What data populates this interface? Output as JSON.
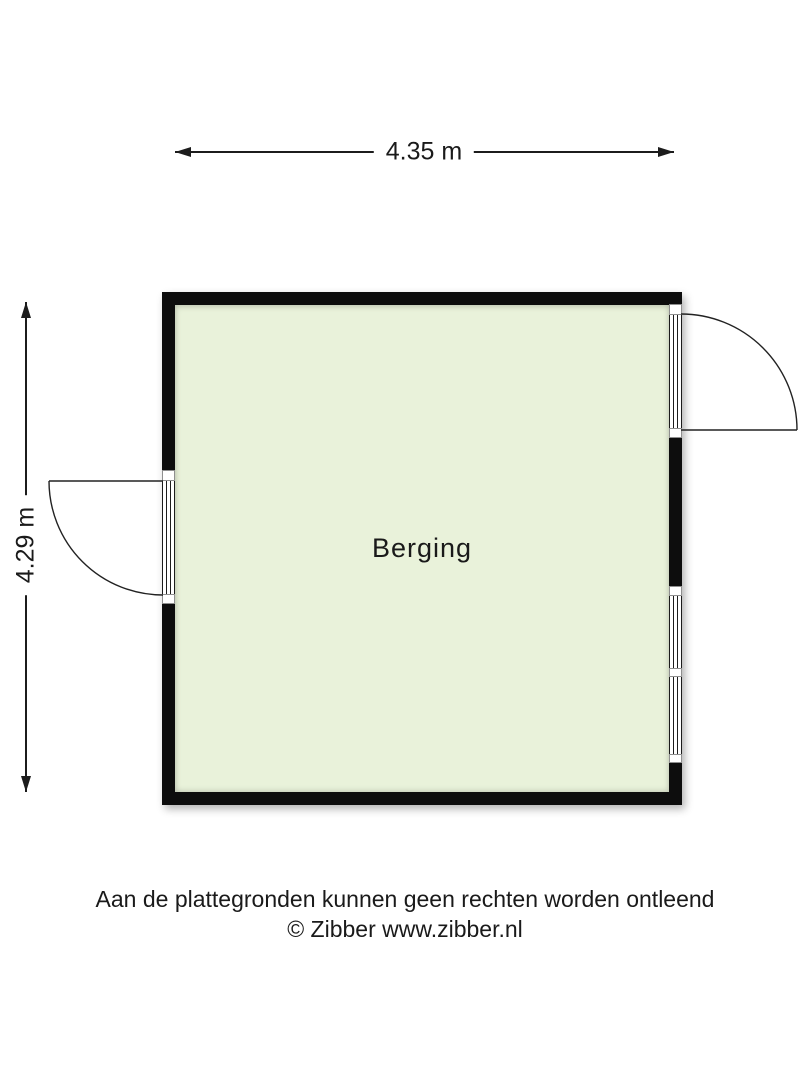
{
  "dimensions": {
    "width_label": "4.35 m",
    "height_label": "4.29 m"
  },
  "plan": {
    "room_label": "Berging",
    "features": {
      "left_door": "door-swing-left",
      "right_door": "door-swing-right",
      "right_windows": 2
    }
  },
  "footer": {
    "disclaimer": "Aan de plattegronden kunnen geen rechten worden ontleend",
    "copyright": "© Zibber www.zibber.nl"
  },
  "colors": {
    "floor": "#e9f2da",
    "wall": "#0d0d0d",
    "line": "#1c1c1c",
    "frame-border": "#8f8f8f",
    "text": "#1a1a1a"
  }
}
